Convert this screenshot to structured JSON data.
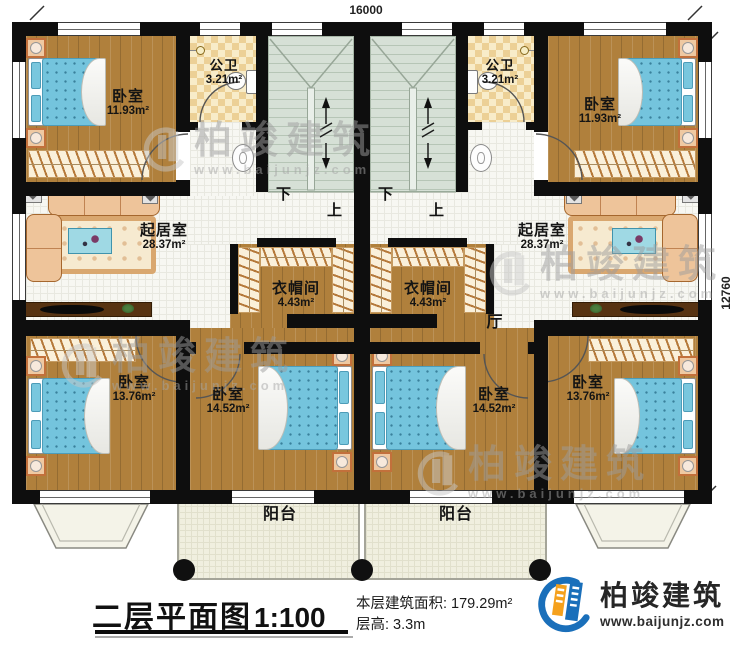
{
  "plan": {
    "dimension_top": "16000",
    "dimension_right": "12760",
    "stairs": {
      "down": "下",
      "up": "上"
    },
    "rooms": {
      "bedroom_top_left": {
        "label": "卧室",
        "area": "11.93m²"
      },
      "bedroom_top_right": {
        "label": "卧室",
        "area": "11.93m²"
      },
      "bathroom_left": {
        "label": "公卫",
        "area": "3.21m²"
      },
      "bathroom_right": {
        "label": "公卫",
        "area": "3.21m²"
      },
      "living_left": {
        "label": "起居室",
        "area": "28.37m²"
      },
      "living_right": {
        "label": "起居室",
        "area": "28.37m²"
      },
      "cloakroom_left": {
        "label": "衣帽间",
        "area": "4.43m²"
      },
      "cloakroom_right": {
        "label": "衣帽间",
        "area": "4.43m²"
      },
      "hall_right": {
        "label": "厅"
      },
      "bedroom_bottom_left": {
        "label": "卧室",
        "area": "13.76m²"
      },
      "bedroom_bottom_mid_left": {
        "label": "卧室",
        "area": "14.52m²"
      },
      "bedroom_bottom_mid_right": {
        "label": "卧室",
        "area": "14.52m²"
      },
      "bedroom_bottom_right": {
        "label": "卧室",
        "area": "13.76m²"
      },
      "balcony_left": {
        "label": "阳台"
      },
      "balcony_right": {
        "label": "阳台"
      }
    },
    "title_block": {
      "title": "二层平面图",
      "scale": "1:100",
      "floor_area_label": "本层建筑面积:",
      "floor_area_value": "179.29m²",
      "floor_height_label": "层高:",
      "floor_height_value": "3.3m"
    },
    "brand": {
      "name": "柏竣建筑",
      "website": "www.baijunjz.com"
    },
    "watermark": {
      "name": "柏竣建筑",
      "website": "www.baijunjz.com"
    },
    "colors": {
      "wall": "#0e0e0e",
      "wood_floor": "#b0803c",
      "tile_floor": "#f7f7f2",
      "bath_checker": "#ecd096",
      "stair": "#d6e0d6",
      "bed_blue": "#74c4dd",
      "balcony": "#f0efdf",
      "brand_blue": "#1a6fba",
      "brand_orange": "#f5a11d"
    }
  }
}
